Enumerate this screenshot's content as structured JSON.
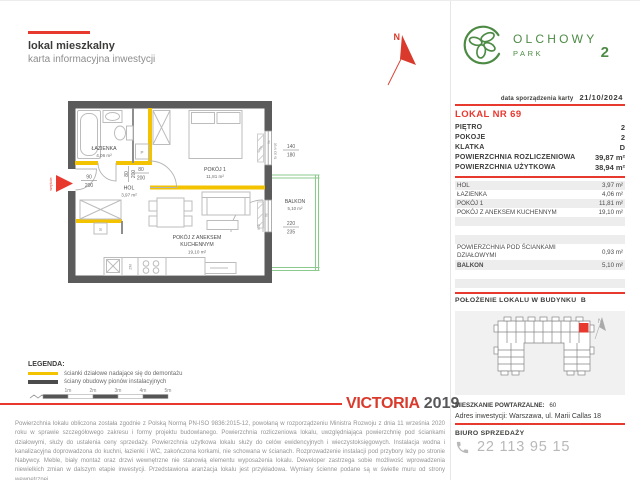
{
  "colors": {
    "accent_red": "#e8392f",
    "brand_green": "#4d8b45",
    "wall_dark": "#5b5b5b",
    "wall_yellow": "#f3c300",
    "balcony_green": "#8cc98c"
  },
  "header": {
    "doc_type": "lokal mieszkalny",
    "doc_subtitle": "karta informacyjna inwestycji",
    "brand": {
      "line1": "OLCHOWY",
      "line2": "PARK",
      "number": "2"
    },
    "date_label": "data sporządzenia karty",
    "date_value": "21/10/2024"
  },
  "unit": {
    "title": "LOKAL NR 69",
    "attributes": [
      {
        "label": "PIĘTRO",
        "value": "2"
      },
      {
        "label": "POKOJE",
        "value": "2"
      },
      {
        "label": "KLATKA",
        "value": "D"
      },
      {
        "label": "POWIERZCHNIA ROZLICZENIOWA",
        "value": "39,87 m²"
      },
      {
        "label": "POWIERZCHNIA UŻYTKOWA",
        "value": "38,94 m²"
      }
    ],
    "rooms": [
      {
        "label": "HOL",
        "value": "3,97 m²"
      },
      {
        "label": "ŁAZIENKA",
        "value": "4,06 m²"
      },
      {
        "label": "POKÓJ 1",
        "value": "11,81 m²"
      },
      {
        "label": "POKÓJ Z ANEKSEM KUCHENNYM",
        "value": "19,10 m²"
      }
    ],
    "extras": [
      {
        "label": "POWIERZCHNIA POD ŚCIANKAMI DZIAŁOWYMI",
        "value": "0,93 m²"
      },
      {
        "label": "BALKON",
        "value": "5,10 m²"
      }
    ]
  },
  "location": {
    "title": "POŁOŻENIE LOKALU W BUDYNKU",
    "building": "B",
    "repeat_label": "MIESZKANIE POWTARZALNE:",
    "repeat_value": "60",
    "address_label": "Adres inwestycji:",
    "address_value": "Warszawa, ul. Marii Callas 18",
    "office_label": "BIURO SPRZEDAŻY",
    "phone": "22 113 95 15"
  },
  "floorplan": {
    "north_label": "N",
    "entrance": {
      "label": "wejście",
      "dim_width": "90",
      "dim_height": "200"
    },
    "labels": {
      "bathroom": "ŁAZIENKA",
      "bathroom_area": "4,06 m²",
      "hall": "HOL",
      "hall_area": "3,97 m²",
      "room1": "POKÓJ 1",
      "room1_area": "11,81 m²",
      "living1": "POKÓJ Z ANEKSEM",
      "living2": "KUCHENNYM",
      "living_area": "19,10 m²",
      "balcony": "BALKON",
      "balcony_area": "5,10 m²"
    },
    "dims": {
      "bathroom_door_w": "80",
      "bathroom_door_h": "200",
      "room1_door_w": "80",
      "room1_door_h": "200",
      "window_w": "140",
      "window_h": "180",
      "window_note1": "fix",
      "window_note2": "fix dol h=90",
      "window_note3": "h=55",
      "balcony_door_w": "220",
      "balcony_door_h": "235",
      "balcony_note1": "fix",
      "balcony_note2": "h=0"
    },
    "appliances": {
      "washer": "P",
      "dishwasher": "ZM",
      "cabinet": "S"
    }
  },
  "legend": {
    "title": "LEGENDA:",
    "items": [
      {
        "label": "ścianki działowe nadające się do demontażu"
      },
      {
        "label": "ściany obudowy pionów instalacyjnych"
      }
    ],
    "scale": [
      "1m",
      "2m",
      "3m",
      "4m",
      "5m"
    ]
  },
  "award": {
    "name": "VICTORIA",
    "year": "2019"
  },
  "footnote": "Powierzchnia lokalu obliczona została zgodnie z Polską Normą PN-ISO 9836:2015-12, powołaną w rozporządzeniu Ministra Rozwoju z dnia 11 września 2020 roku w sprawie szczegółowego zakresu i formy projektu budowlanego. Powierzchnia rozliczeniowa lokalu, uwzględniająca powierzchnię pod ściankami działowymi, służy do ustalenia ceny sprzedaży. Powierzchnia użytkowa lokalu służy do celów ewidencyjnych i wieczystoksięgowych. Instalacja wodna i kanalizacyjna doprowadzona do kuchni, łazienki i WC, zakończona korkami, nie schowana w ścianach. Rozprowadzenie instalacji pod przybory leży po stronie Nabywcy. Meble, biały montaż oraz drzwi wewnętrzne nie stanowią elementu wyposażenia lokalu. Deweloper zastrzega sobie możliwość wprowadzenia niewielkich zmian w dalszym etapie inwestycji. Przedstawiona aranżacja lokalu jest przykładowa. Wymiary ścienne podane są w świetle muru od strony wewnętrznej."
}
